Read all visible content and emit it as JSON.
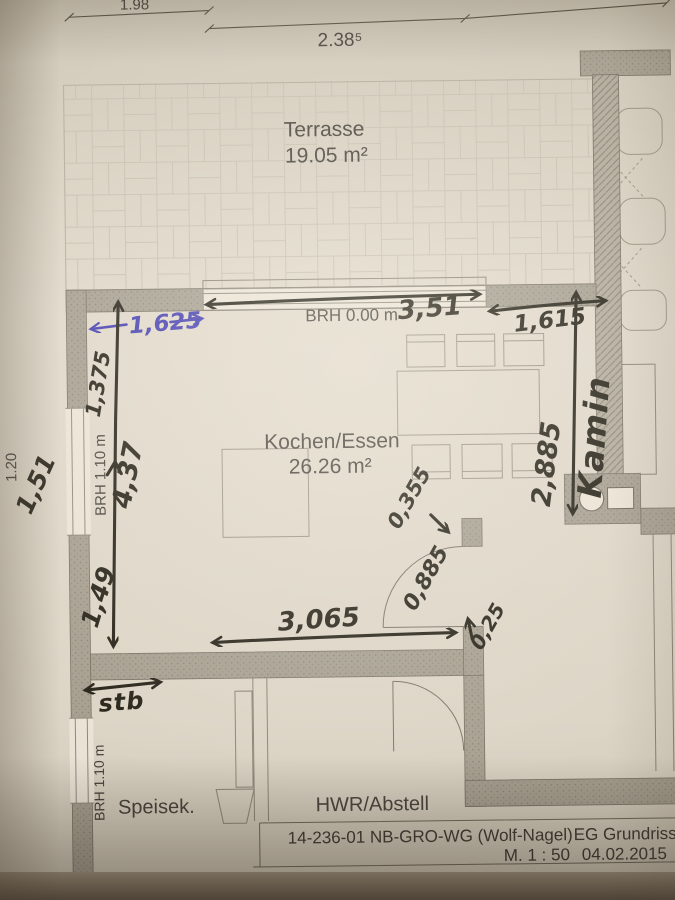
{
  "photo": {
    "description": "photographed architectural floor plan page",
    "paper_color": "#ded6c7",
    "wall_color": "#a59f91",
    "ink_color": "#46413a",
    "pen_color": "#262218",
    "blue_pen_color": "#443db0"
  },
  "top_dimensions": {
    "left_segment": "1.98",
    "right_segment": "2.38⁵"
  },
  "left_margin_dimension": "1.20",
  "rooms": {
    "terrasse": {
      "name": "Terrasse",
      "area": "19.05 m²"
    },
    "kochen_essen": {
      "name": "Kochen/Essen",
      "area": "26.26 m²"
    },
    "speisekammer": {
      "name": "Speisek."
    },
    "hwr": {
      "name": "HWR/Abstell"
    }
  },
  "printed_labels": {
    "brh_terrace_door": "BRH 0.00 m",
    "brh_left_window": "BRH 1.10 m",
    "brh_speisek_window": "BRH 1.10 m"
  },
  "handwritten_dimensions": {
    "terrace_door_width": "3,51",
    "blue_width": "1,625",
    "upper_left_height": "1,375",
    "left_window_width": "1,51",
    "room_height": "4,37",
    "lower_left_height": "1,49",
    "right_width": "1,615",
    "right_height": "2,885",
    "kamin_label": "Kamin",
    "door_offset": "0,355",
    "door_width": "0,885",
    "wall_piece": "0,25",
    "bottom_opening_width": "3,065",
    "stb_note": "stb"
  },
  "title_block": {
    "project": "14-236-01 NB-GRO-WG (Wolf-Nagel)",
    "drawing": "EG Grundriss",
    "scale": "M. 1 : 50",
    "date": "04.02.2015"
  }
}
